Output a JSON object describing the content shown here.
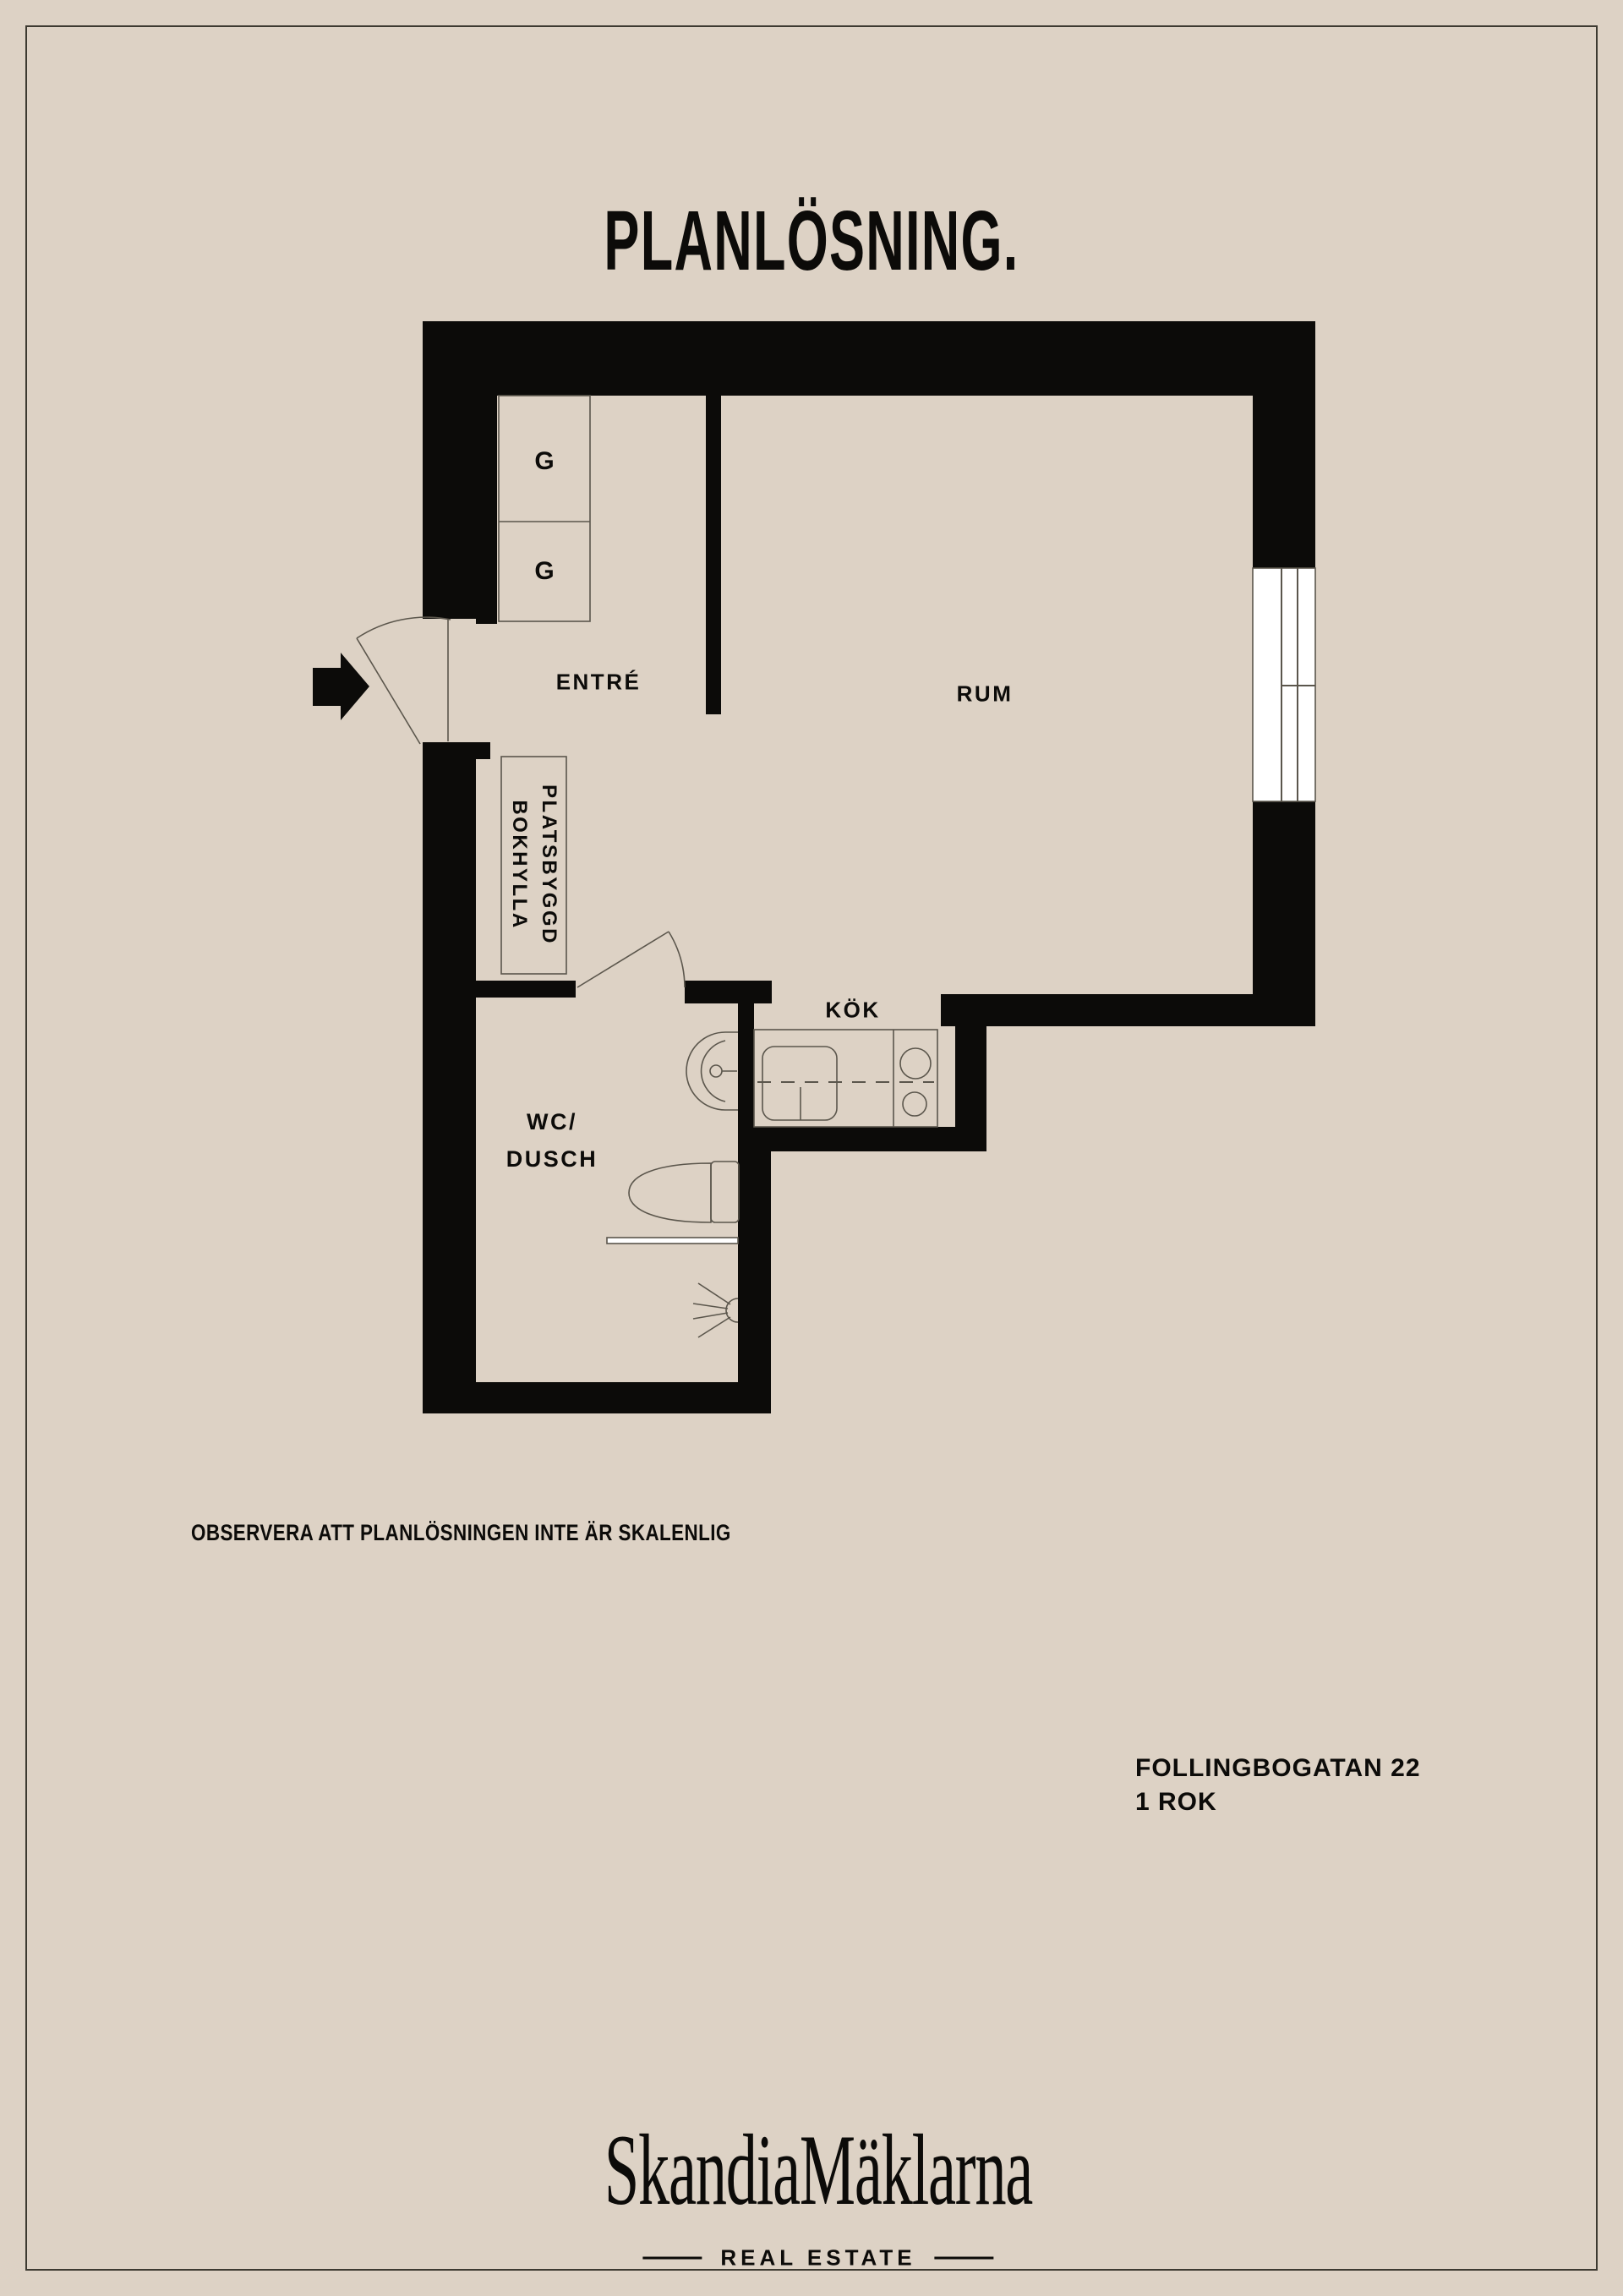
{
  "colors": {
    "background": "#DDD2C5",
    "ink": "#0C0B09",
    "line": "#5B564C",
    "frame": "#3D3A31",
    "window": "#FFFFFF"
  },
  "header": {
    "title": "PLANLÖSNING."
  },
  "floorplan": {
    "labels": {
      "entre": "ENTRÉ",
      "rum": "RUM",
      "kok": "KÖK",
      "wc_line1": "WC/",
      "wc_line2": "DUSCH",
      "closet_top": "G",
      "closet_bottom": "G",
      "bookshelf_line1": "PLATSBYGGD",
      "bookshelf_line2": "BOKHYLLA"
    },
    "note": "OBSERVERA ATT PLANLÖSNINGEN INTE ÄR SKALENLIG"
  },
  "property": {
    "address": "FOLLINGBOGATAN 22",
    "layout": "1 ROK"
  },
  "brand": {
    "name": "SkandiaMäklarna",
    "tagline": "REAL ESTATE"
  }
}
